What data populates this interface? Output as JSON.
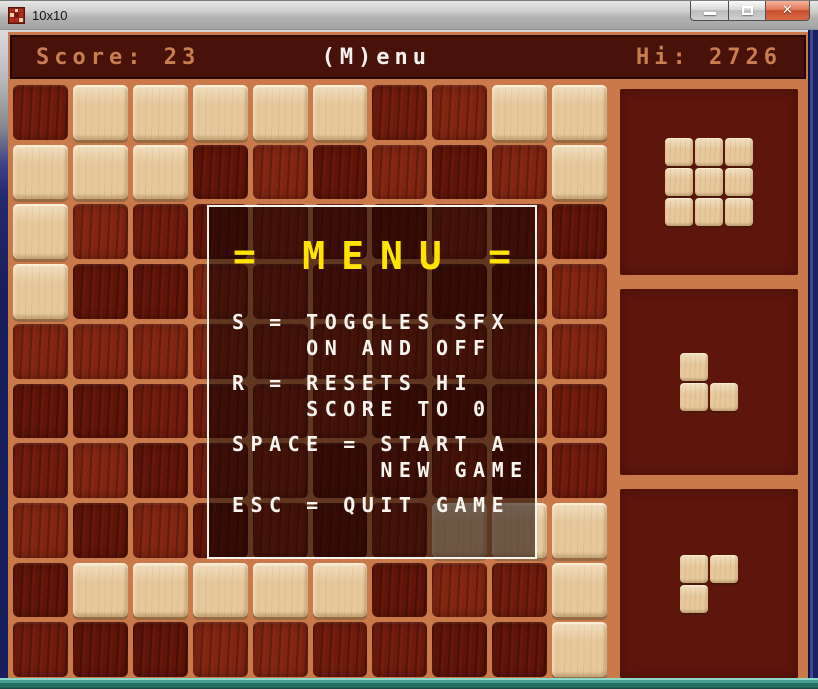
{
  "titlebar": {
    "title": "10x10",
    "close_glyph": "✕"
  },
  "header": {
    "score_label": "Score:",
    "score_value": "23",
    "menu_label": "(M)enu",
    "hi_label": "Hi:",
    "hi_value": "2726"
  },
  "board": {
    "rows_count": 10,
    "cols_count": 10,
    "rows": [
      "0111110011",
      "1110000001",
      "1000000000",
      "1000000000",
      "0000000000",
      "0000000000",
      "0000000000",
      "0000000111",
      "0111110001",
      "0000000001"
    ]
  },
  "pieces": [
    {
      "name": "square-3x3",
      "grid": [
        "111",
        "111",
        "111"
      ]
    },
    {
      "name": "corner-bottom-right",
      "grid": [
        "10",
        "11"
      ]
    },
    {
      "name": "corner-top-left",
      "grid": [
        "11",
        "10"
      ]
    }
  ],
  "menu": {
    "title_left": "=",
    "title": "MENU",
    "title_right": "=",
    "items": [
      {
        "lines": [
          "S = TOGGLES SFX",
          "    ON AND OFF"
        ]
      },
      {
        "lines": [
          "R = RESETS HI",
          "    SCORE TO 0"
        ]
      },
      {
        "lines": [
          "SPACE = START A",
          "        NEW GAME"
        ]
      },
      {
        "lines": [
          "ESC = QUIT GAME"
        ]
      }
    ]
  },
  "colors": {
    "board_background": "#c9794a",
    "header_background": "#48120a",
    "panel_background": "#5d150c",
    "empty_cell": "#6e1b0d",
    "filled_cell": "#e6c89c",
    "accent_text": "#c97e52",
    "menu_title": "#ffe400",
    "menu_text": "#f7f5f0",
    "close_button": "#ca4f2e",
    "bottom_edge": "#256e63"
  }
}
